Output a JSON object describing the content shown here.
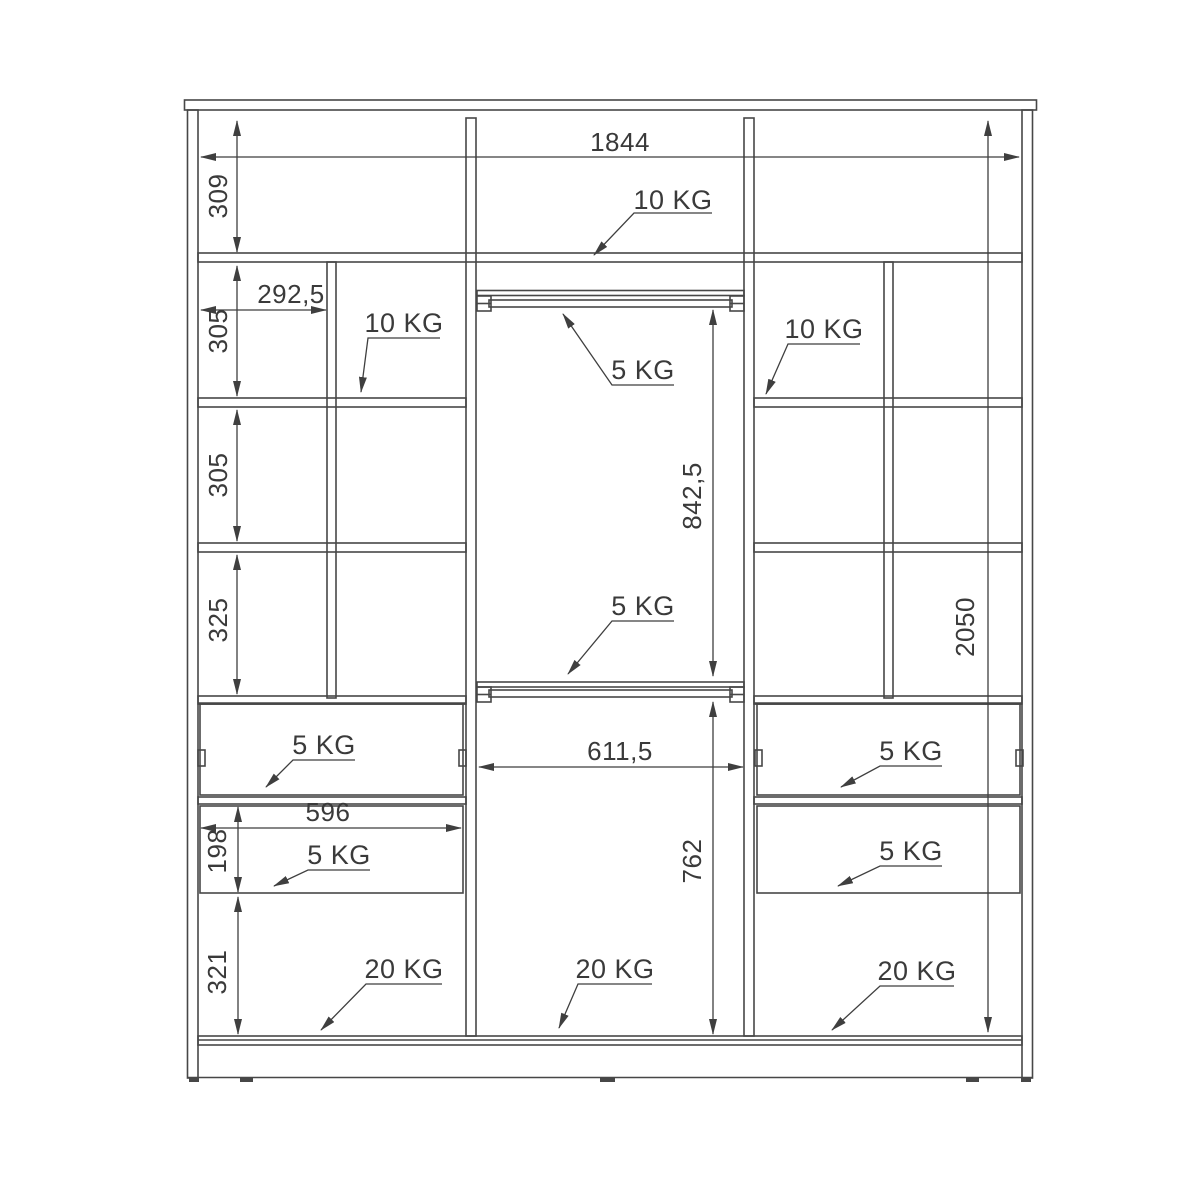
{
  "diagram": {
    "type": "wardrobe-interior-technical-drawing",
    "dims": {
      "overall_width": "1844",
      "top_section_height": "309",
      "left_column_width": "292,5",
      "left_row1_height": "305",
      "left_row2_height": "305",
      "left_row3_height": "325",
      "drawer_width": "596",
      "drawer_height": "198",
      "bottom_section_height": "321",
      "middle_upper_height": "842,5",
      "middle_width": "611,5",
      "middle_lower_height": "762",
      "overall_height": "2050"
    },
    "loads": {
      "top_shelf": "10 KG",
      "left_shelf": "10 KG",
      "right_shelf": "10 KG",
      "upper_rail": "5 KG",
      "lower_rail": "5 KG",
      "left_drawer_1": "5 KG",
      "left_drawer_2": "5 KG",
      "right_drawer_1": "5 KG",
      "right_drawer_2": "5 KG",
      "floor_left": "20 KG",
      "floor_middle": "20 KG",
      "floor_right": "20 KG"
    },
    "colors": {
      "line": "#474747",
      "text": "#3a3a3a",
      "background": "#ffffff"
    }
  }
}
